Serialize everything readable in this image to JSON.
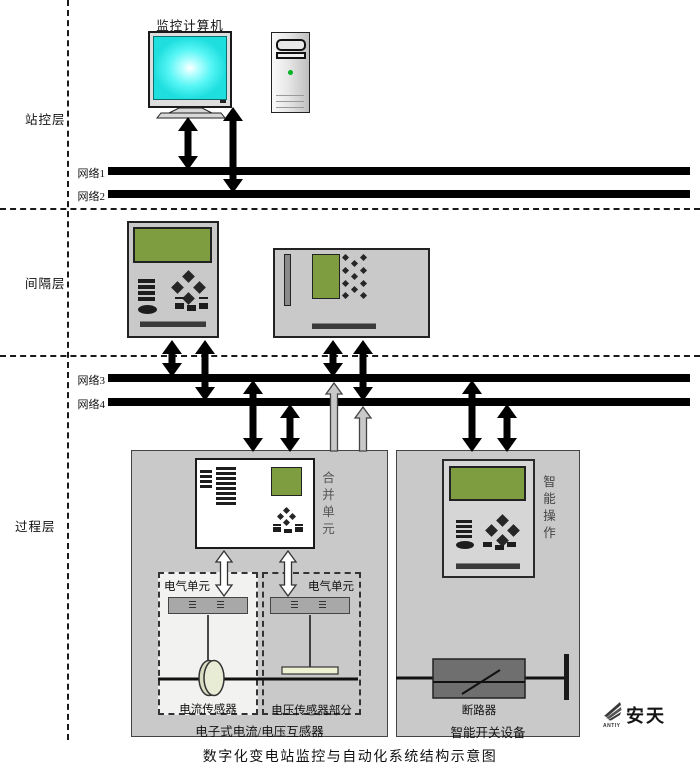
{
  "caption": "数字化变电站监控与自动化系统结构示意图",
  "layers": {
    "station": "站控层",
    "bay": "间隔层",
    "process": "过程层"
  },
  "networks": [
    {
      "label": "网络1"
    },
    {
      "label": "网络2"
    },
    {
      "label": "网络3"
    },
    {
      "label": "网络4"
    }
  ],
  "station": {
    "computer_label": "监控计算机"
  },
  "process": {
    "merging_unit": "合并单元",
    "electrical_unit_left": "电气单元",
    "electrical_unit_right": "电气单元",
    "current_sensor": "电流传感器",
    "voltage_sensor": "电压传感器部分",
    "transformer_caption": "电子式电流/电压互感器",
    "smart_operation": "智能操作",
    "breaker": "断路器",
    "switchgear_caption": "智能开关设备"
  },
  "logo": {
    "name": "安天",
    "sub": "ANTIY"
  },
  "colors": {
    "screen_green": "#7e9c40",
    "monitor_cyan": "#33f0f0",
    "box_gray": "#c9c9c9",
    "line_black": "#000000"
  }
}
